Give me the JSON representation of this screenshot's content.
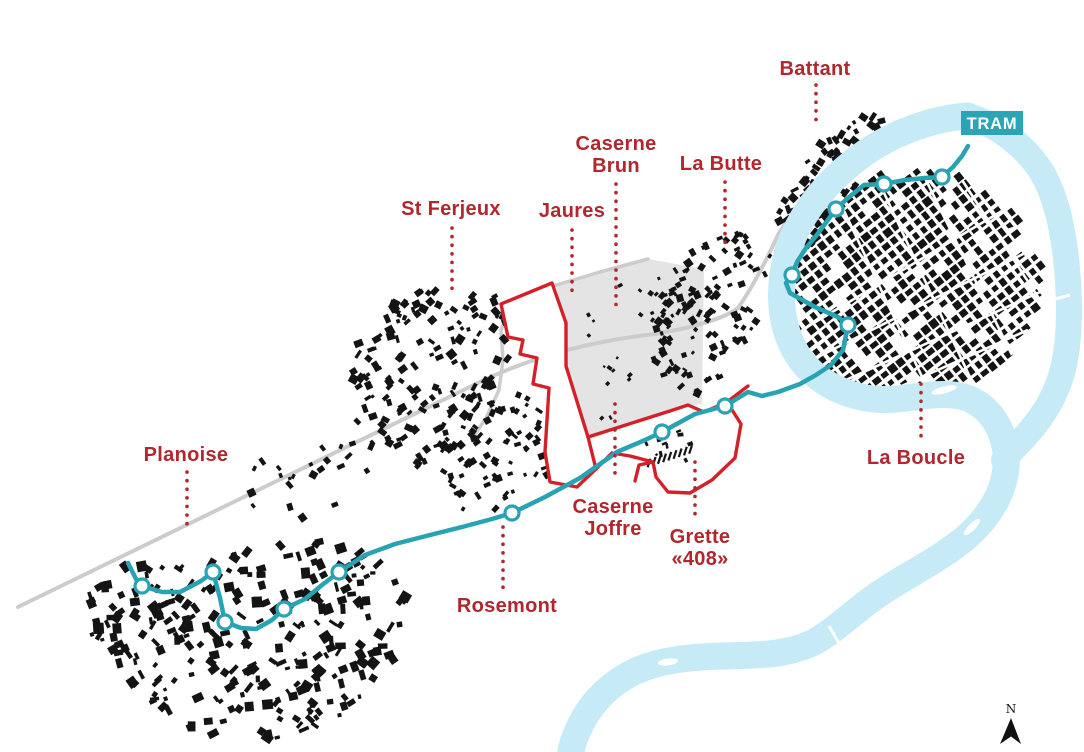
{
  "map": {
    "badge": {
      "label": "TRAM"
    },
    "north": {
      "label": "N"
    },
    "colors": {
      "label_red": "#b2262e",
      "outline_red": "#d42029",
      "tram_teal": "#27a3b4",
      "badge_teal": "#2ba4b6",
      "river_blue": "#c7eaf7",
      "rail_gray": "#cccccc",
      "zone_gray": "#e4e4e4",
      "building_black": "#141414"
    },
    "districts": [
      {
        "name": "battant",
        "lines": [
          "Battant"
        ],
        "x": 815,
        "y": 75,
        "leader": {
          "x": 816,
          "y1": 85,
          "y2": 122
        }
      },
      {
        "name": "caserne-brun",
        "lines": [
          "Caserne",
          "Brun"
        ],
        "x": 616,
        "y": 150,
        "leader": {
          "x": 616,
          "y1": 184,
          "y2": 312
        }
      },
      {
        "name": "la-butte",
        "lines": [
          "La Butte"
        ],
        "x": 721,
        "y": 170,
        "leader": {
          "x": 725,
          "y1": 182,
          "y2": 248
        }
      },
      {
        "name": "st-ferjeux",
        "lines": [
          "St Ferjeux"
        ],
        "x": 451,
        "y": 215,
        "leader": {
          "x": 452,
          "y1": 228,
          "y2": 290
        }
      },
      {
        "name": "jaures",
        "lines": [
          "Jaures"
        ],
        "x": 572,
        "y": 217,
        "leader": {
          "x": 572,
          "y1": 230,
          "y2": 296
        }
      },
      {
        "name": "planoise",
        "lines": [
          "Planoise"
        ],
        "x": 186,
        "y": 461,
        "leader": {
          "x": 187,
          "y1": 472,
          "y2": 528
        }
      },
      {
        "name": "rosemont",
        "lines": [
          "Rosemont"
        ],
        "x": 507,
        "y": 612,
        "leader": {
          "x": 503,
          "y1": 527,
          "y2": 592
        }
      },
      {
        "name": "caserne-joffre",
        "lines": [
          "Caserne",
          "Joffre"
        ],
        "x": 613,
        "y": 513,
        "leader": {
          "x": 615,
          "y1": 404,
          "y2": 478
        }
      },
      {
        "name": "grette-408",
        "lines": [
          "Grette",
          "«408»"
        ],
        "x": 700,
        "y": 543,
        "leader": {
          "x": 695,
          "y1": 462,
          "y2": 518
        }
      },
      {
        "name": "la-boucle",
        "lines": [
          "La Boucle"
        ],
        "x": 916,
        "y": 464,
        "leader": {
          "x": 921,
          "y1": 384,
          "y2": 440
        }
      }
    ],
    "tram": {
      "points": [
        [
          128,
          563
        ],
        [
          136,
          579
        ],
        [
          142,
          586
        ],
        [
          162,
          592
        ],
        [
          180,
          592
        ],
        [
          201,
          581
        ],
        [
          213,
          572
        ],
        [
          220,
          598
        ],
        [
          225,
          622
        ],
        [
          241,
          628
        ],
        [
          256,
          629
        ],
        [
          272,
          620
        ],
        [
          284,
          609
        ],
        [
          305,
          599
        ],
        [
          322,
          585
        ],
        [
          339,
          572
        ],
        [
          365,
          555
        ],
        [
          395,
          544
        ],
        [
          430,
          535
        ],
        [
          462,
          527
        ],
        [
          492,
          519
        ],
        [
          512,
          513
        ],
        [
          545,
          497
        ],
        [
          580,
          478
        ],
        [
          617,
          452
        ],
        [
          645,
          440
        ],
        [
          662,
          432
        ],
        [
          695,
          414
        ],
        [
          725,
          406
        ],
        [
          748,
          392
        ],
        [
          762,
          396
        ],
        [
          778,
          392
        ],
        [
          800,
          384
        ],
        [
          816,
          375
        ],
        [
          831,
          365
        ],
        [
          843,
          350
        ],
        [
          848,
          325
        ],
        [
          838,
          317
        ],
        [
          815,
          307
        ],
        [
          790,
          293
        ],
        [
          786,
          283
        ],
        [
          792,
          275
        ],
        [
          797,
          262
        ],
        [
          806,
          248
        ],
        [
          816,
          236
        ],
        [
          836,
          209
        ],
        [
          848,
          198
        ],
        [
          864,
          185
        ],
        [
          884,
          184
        ],
        [
          905,
          180
        ],
        [
          925,
          178
        ],
        [
          942,
          177
        ],
        [
          953,
          167
        ],
        [
          962,
          156
        ],
        [
          968,
          146
        ]
      ],
      "stops": [
        [
          142,
          586
        ],
        [
          213,
          572
        ],
        [
          225,
          622
        ],
        [
          284,
          609
        ],
        [
          339,
          572
        ],
        [
          512,
          513
        ],
        [
          662,
          432
        ],
        [
          725,
          406
        ],
        [
          848,
          325
        ],
        [
          792,
          275
        ],
        [
          836,
          209
        ],
        [
          884,
          184
        ],
        [
          942,
          177
        ]
      ]
    },
    "river": {
      "main": "M968,116 C935,118 892,132 858,158 C824,184 800,215 789,248 C779,280 778,315 792,345 C806,374 833,392 866,398 C899,404 930,390 960,396 C986,402 1002,424 1006,452 C1009,485 992,516 963,540 C934,563 903,577 876,596 C852,613 838,628 816,641 C788,656 755,655 722,656 C690,657 660,660 636,671 C612,682 594,700 583,720 C575,735 572,744 571,752",
      "east": "M968,116 C1000,126 1028,148 1044,176 C1058,202 1064,235 1067,268 C1070,303 1070,340 1063,369 C1056,397 1040,422 1018,444 C1010,452 1006,456 1004,460",
      "islands": [
        [
          941,
          143,
          10,
          3,
          -35
        ],
        [
          944,
          390,
          13,
          3.5,
          -15
        ],
        [
          972,
          527,
          11,
          3.5,
          -45
        ],
        [
          668,
          662,
          10,
          3.5,
          -8
        ]
      ],
      "bridges": [
        [
          1008,
          230,
          1044,
          219
        ],
        [
          1040,
          303,
          1070,
          295
        ],
        [
          829,
          626,
          843,
          650
        ]
      ]
    },
    "railway": "M18,607 L480,382 C540,353 600,340 655,334 C690,328 722,320 738,308 C752,288 766,261 779,233 L788,220",
    "roads": [
      "M648,259 L600,272 L560,284 L532,291 L512,306 L501,330 L503,360 L499,390 L486,418 L474,436"
    ],
    "zone_points": "556,287 648,259 704,269 702,404 688,406 590,439 566,368 566,323",
    "red_lobe": "M552,283 L501,304 L508,337 L523,340 L520,354 L537,358 L533,384 L549,388 L545,452 L550,482 L577,487 L596,469 L588,437 L566,366 L566,323 Z",
    "red_corridor": "M588,437 L673,410 L688,405 L704,412 L727,402 L748,386 M727,402 L741,424 L735,458 L712,480 L690,493 L668,492 L656,477 L653,462 L639,465 L635,481 M653,462 L630,456 L612,453 L596,469",
    "streets": [
      [
        802,
        330,
        1012,
        205
      ],
      [
        812,
        360,
        1035,
        248
      ],
      [
        835,
        385,
        1040,
        292
      ],
      [
        870,
        400,
        1028,
        330
      ],
      [
        838,
        198,
        932,
        398
      ],
      [
        878,
        180,
        975,
        388
      ],
      [
        922,
        172,
        1012,
        355
      ],
      [
        962,
        180,
        1040,
        300
      ]
    ],
    "bars": {
      "x0": 649,
      "y0": 463,
      "dx": 5.2,
      "dy": -1.7,
      "n": 9,
      "w": 2.2,
      "h": 9,
      "rot": 18
    },
    "clusters": [
      {
        "name": "battant",
        "type": "random",
        "seed": 7,
        "count": 110,
        "min": 3,
        "max": 9,
        "angle": -40,
        "jitter": 50,
        "poly": [
          [
            780,
            270
          ],
          [
            775,
            225
          ],
          [
            788,
            185
          ],
          [
            808,
            155
          ],
          [
            832,
            132
          ],
          [
            858,
            116
          ],
          [
            885,
            112
          ],
          [
            900,
            125
          ],
          [
            888,
            150
          ],
          [
            865,
            175
          ],
          [
            840,
            205
          ],
          [
            818,
            235
          ],
          [
            800,
            260
          ]
        ]
      },
      {
        "name": "la-boucle",
        "type": "grid",
        "seed": 11,
        "angle": -38,
        "spacing": 10,
        "cell": 6.8,
        "skip": 0.14,
        "poly": [
          [
            800,
            345
          ],
          [
            792,
            295
          ],
          [
            800,
            250
          ],
          [
            818,
            215
          ],
          [
            845,
            190
          ],
          [
            878,
            175
          ],
          [
            915,
            170
          ],
          [
            955,
            175
          ],
          [
            995,
            195
          ],
          [
            1025,
            222
          ],
          [
            1042,
            255
          ],
          [
            1042,
            295
          ],
          [
            1028,
            330
          ],
          [
            1005,
            360
          ],
          [
            975,
            382
          ],
          [
            940,
            396
          ],
          [
            900,
            402
          ],
          [
            860,
            400
          ],
          [
            826,
            380
          ]
        ]
      },
      {
        "name": "la-butte",
        "type": "random",
        "seed": 13,
        "count": 115,
        "min": 3,
        "max": 8,
        "angle": -40,
        "jitter": 50,
        "poly": [
          [
            655,
            335
          ],
          [
            662,
            295
          ],
          [
            680,
            262
          ],
          [
            705,
            240
          ],
          [
            735,
            230
          ],
          [
            765,
            238
          ],
          [
            778,
            255
          ],
          [
            772,
            292
          ],
          [
            756,
            325
          ],
          [
            738,
            358
          ],
          [
            716,
            386
          ],
          [
            692,
            400
          ],
          [
            668,
            390
          ],
          [
            656,
            365
          ]
        ]
      },
      {
        "name": "st-ferjeux",
        "type": "random",
        "seed": 17,
        "count": 150,
        "min": 3,
        "max": 9,
        "angle": -42,
        "jitter": 55,
        "poly": [
          [
            348,
            382
          ],
          [
            360,
            338
          ],
          [
            385,
            308
          ],
          [
            418,
            290
          ],
          [
            455,
            283
          ],
          [
            492,
            290
          ],
          [
            512,
            318
          ],
          [
            508,
            358
          ],
          [
            490,
            400
          ],
          [
            464,
            438
          ],
          [
            434,
            464
          ],
          [
            400,
            472
          ],
          [
            370,
            458
          ],
          [
            350,
            422
          ]
        ]
      },
      {
        "name": "joffre-south",
        "type": "random",
        "seed": 19,
        "count": 85,
        "min": 3,
        "max": 8,
        "angle": -42,
        "jitter": 55,
        "poly": [
          [
            430,
            420
          ],
          [
            468,
            396
          ],
          [
            508,
            390
          ],
          [
            542,
            400
          ],
          [
            560,
            424
          ],
          [
            556,
            458
          ],
          [
            538,
            492
          ],
          [
            510,
            516
          ],
          [
            478,
            520
          ],
          [
            450,
            500
          ],
          [
            434,
            462
          ]
        ]
      },
      {
        "name": "planoise",
        "type": "random",
        "seed": 23,
        "count": 280,
        "min": 3,
        "max": 11,
        "angle": -30,
        "jitter": 60,
        "poly": [
          [
            78,
            602
          ],
          [
            108,
            572
          ],
          [
            140,
            558
          ],
          [
            175,
            556
          ],
          [
            205,
            565
          ],
          [
            232,
            552
          ],
          [
            262,
            542
          ],
          [
            295,
            540
          ],
          [
            330,
            540
          ],
          [
            362,
            552
          ],
          [
            390,
            572
          ],
          [
            408,
            598
          ],
          [
            412,
            628
          ],
          [
            398,
            658
          ],
          [
            372,
            685
          ],
          [
            345,
            712
          ],
          [
            312,
            738
          ],
          [
            275,
            750
          ],
          [
            235,
            748
          ],
          [
            198,
            735
          ],
          [
            162,
            712
          ],
          [
            128,
            685
          ],
          [
            100,
            650
          ],
          [
            82,
            625
          ]
        ]
      },
      {
        "name": "mid-sparse",
        "type": "random",
        "seed": 29,
        "count": 22,
        "min": 3,
        "max": 8,
        "angle": -42,
        "jitter": 60,
        "poly": [
          [
            230,
            468
          ],
          [
            285,
            448
          ],
          [
            345,
            438
          ],
          [
            385,
            462
          ],
          [
            362,
            508
          ],
          [
            305,
            528
          ],
          [
            248,
            515
          ]
        ]
      },
      {
        "name": "zone-specks",
        "type": "random",
        "seed": 31,
        "count": 30,
        "min": 2,
        "max": 5,
        "angle": -40,
        "jitter": 40,
        "poly": [
          [
            572,
            300
          ],
          [
            640,
            272
          ],
          [
            695,
            290
          ],
          [
            695,
            395
          ],
          [
            600,
            430
          ],
          [
            574,
            380
          ]
        ]
      },
      {
        "name": "grette-specks",
        "type": "random",
        "seed": 37,
        "count": 10,
        "min": 2,
        "max": 6,
        "angle": -20,
        "jitter": 30,
        "poly": [
          [
            640,
            432
          ],
          [
            700,
            428
          ],
          [
            706,
            468
          ],
          [
            650,
            470
          ]
        ]
      }
    ]
  }
}
